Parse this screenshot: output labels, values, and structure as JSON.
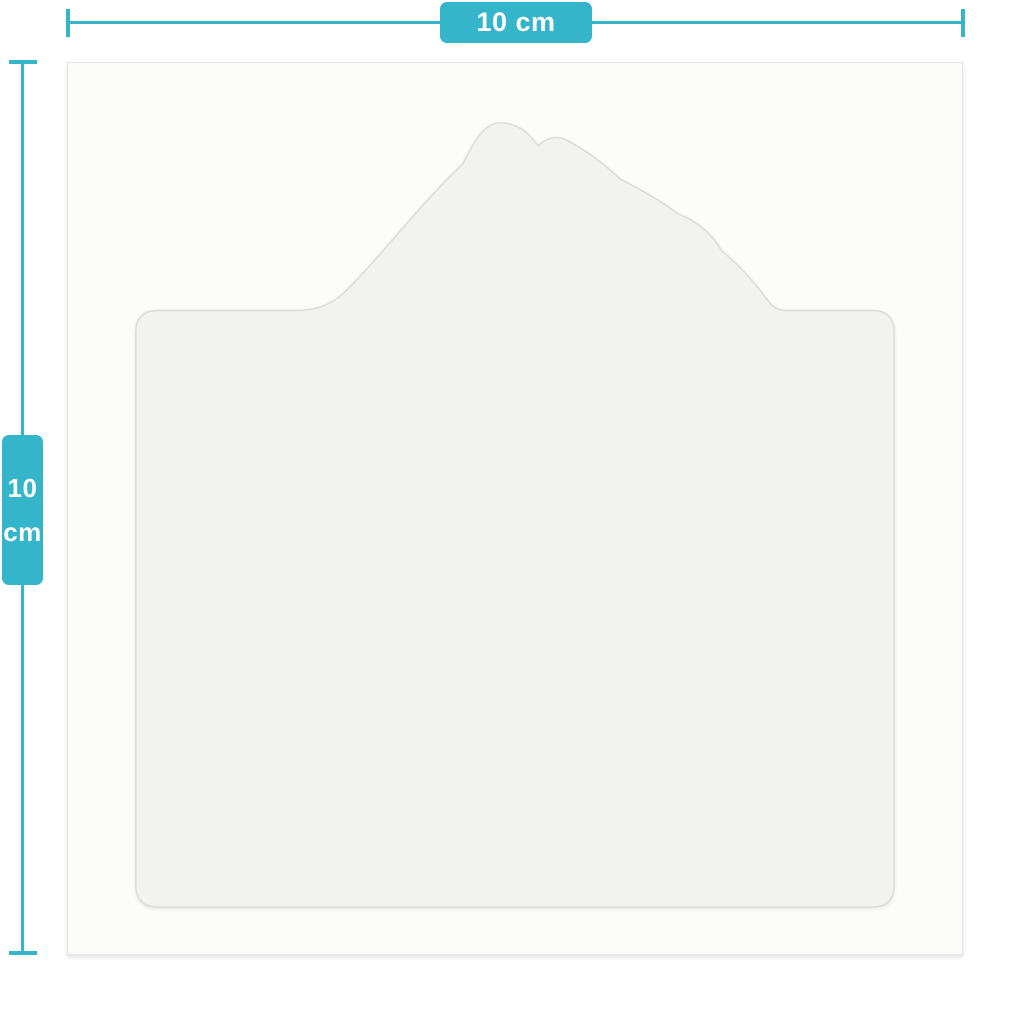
{
  "diagram": {
    "type": "product-dimension-diagram",
    "horizontal_dimension": {
      "label": "10 cm"
    },
    "vertical_dimension": {
      "label_line1": "10",
      "label_line2": "cm"
    },
    "product": {
      "description": "blank white stencil / plaque shape with scalloped crest on rounded square base",
      "shape_name": "stencil-blank-shape"
    },
    "colors": {
      "accent_teal": "#35b5ca",
      "badge_text": "#ffffff",
      "page_background": "#ffffff",
      "canvas_background": "#fcfcfb",
      "canvas_border": "#e4e4e2",
      "shape_fill": "#f2f2f0",
      "shape_edge": "#dcdcd9"
    }
  }
}
